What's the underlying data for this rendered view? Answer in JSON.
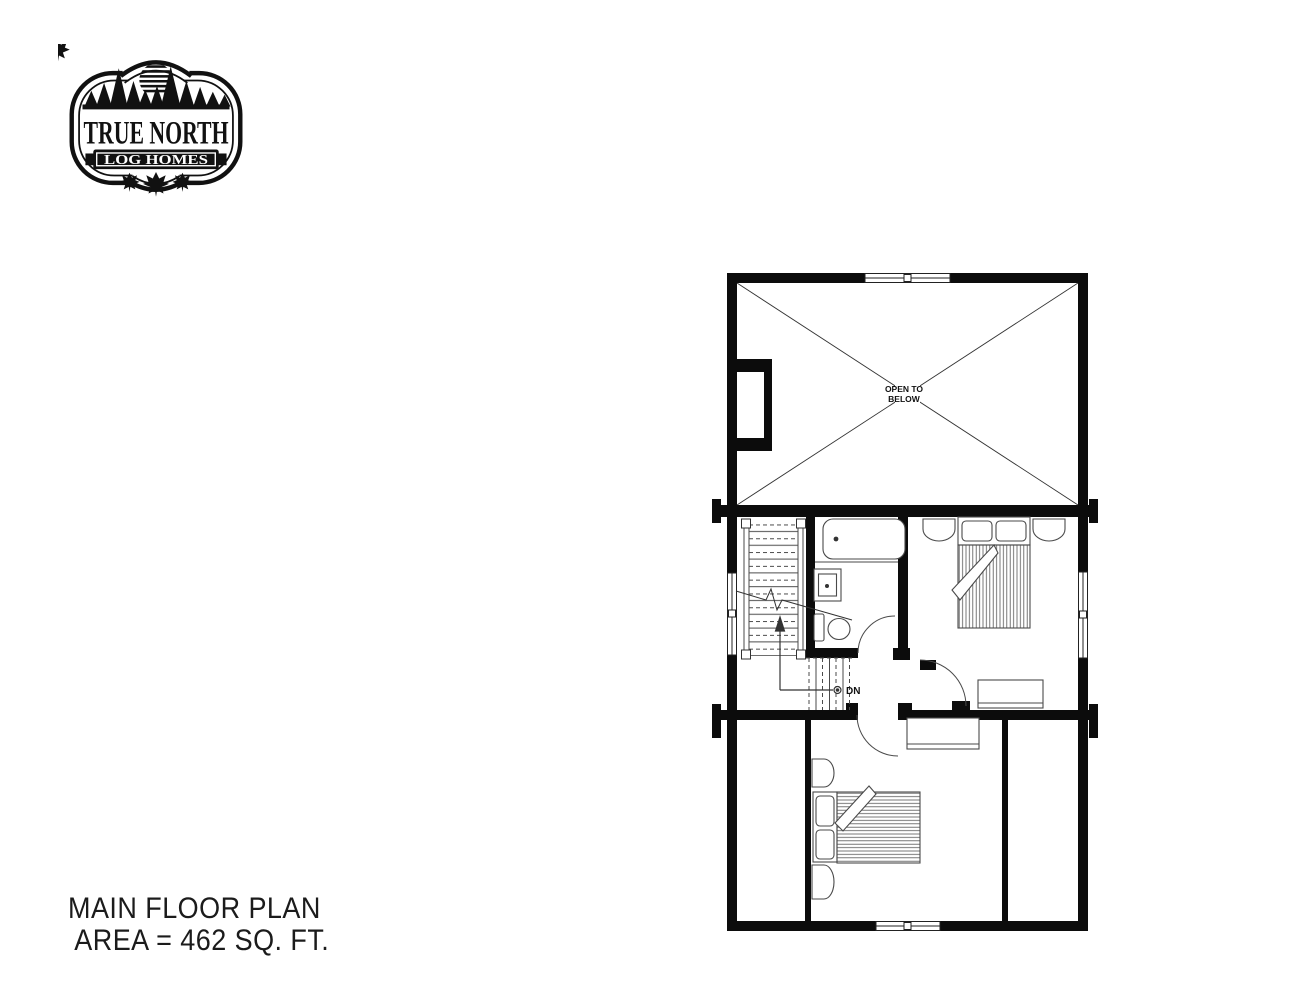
{
  "page": {
    "paper": "#ffffff",
    "ink": "#0c0c0c",
    "line": "#4a4a4a"
  },
  "logo": {
    "wordmark": "TRUE NORTH",
    "banner": "LOG HOMES"
  },
  "plan": {
    "open_room": {
      "label_line1": "OPEN TO",
      "label_line2": "BELOW"
    },
    "stairs": {
      "direction_label": "DN"
    }
  },
  "caption": {
    "line1": "MAIN FLOOR PLAN",
    "line2": "AREA = 462 SQ. FT."
  }
}
